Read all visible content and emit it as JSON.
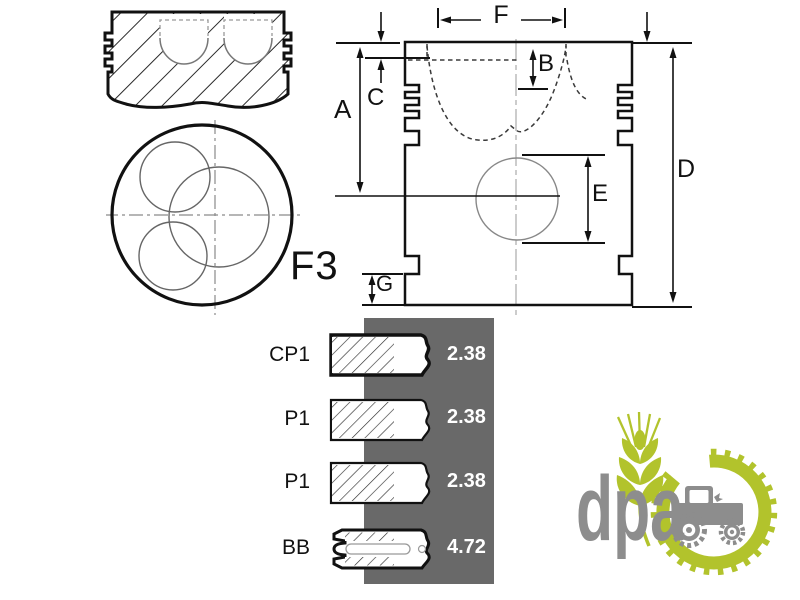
{
  "drawing": {
    "top_view_label": "F3",
    "dimension_labels": {
      "a": "A",
      "b": "B",
      "c": "C",
      "d": "D",
      "e": "E",
      "f": "F",
      "g": "G"
    }
  },
  "rings": {
    "rows": [
      {
        "label": "CP1",
        "value": "2.38"
      },
      {
        "label": "P1",
        "value": "2.38"
      },
      {
        "label": "P1",
        "value": "2.38"
      },
      {
        "label": "BB",
        "value": "4.72"
      }
    ]
  },
  "logo": {
    "text": "dpa"
  },
  "colors": {
    "line": "#1a1a1a",
    "panel_gray": "#696969",
    "value_text": "#ffffff",
    "logo_green": "#b2c32c",
    "logo_gray": "#8d8d8d"
  }
}
